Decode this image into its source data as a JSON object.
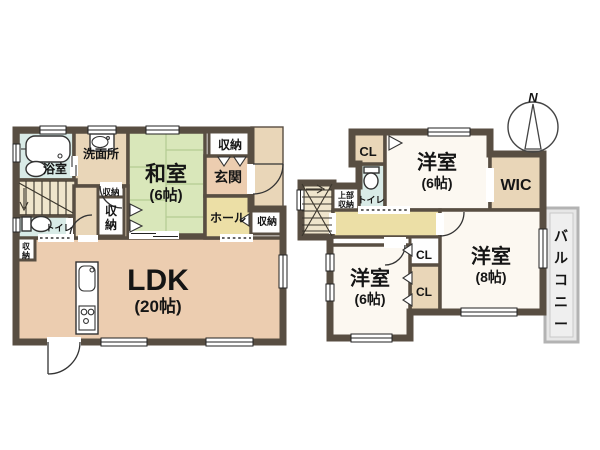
{
  "palette": {
    "wall": "#584e42",
    "peach": "#eccdb0",
    "beige": "#e9d6b8",
    "green": "#d9e7ba",
    "yellow": "#ecdfa6",
    "cyan": "#d9ebe7",
    "room_white": "#fcf8f1",
    "box_white": "#fefefe",
    "stair_beige": "#efe5cc",
    "balcony_fill": "#e7e7e7",
    "balcony_border": "#b3b3b3"
  },
  "floor1": {
    "ldk_label": "LDK",
    "ldk_size": "(20帖)",
    "washitsu_label": "和室",
    "washitsu_size": "(6帖)",
    "bath_label": "浴室",
    "washroom_label": "洗面所",
    "toilet_label": "トイレ",
    "genkan_label": "玄関",
    "hall_label": "ホール",
    "storage_label": "収納",
    "storage_char1": "収",
    "storage_char2": "納"
  },
  "floor2": {
    "western_label": "洋室",
    "size_6": "(6帖)",
    "size_8": "(8帖)",
    "wic_label": "WIC",
    "cl_label": "CL",
    "toilet_label": "トイレ",
    "upper_storage_line1": "上部",
    "upper_storage_line2": "収納",
    "balcony_chars": [
      "バ",
      "ル",
      "コ",
      "ニ",
      "ー"
    ],
    "compass_north": "N"
  }
}
